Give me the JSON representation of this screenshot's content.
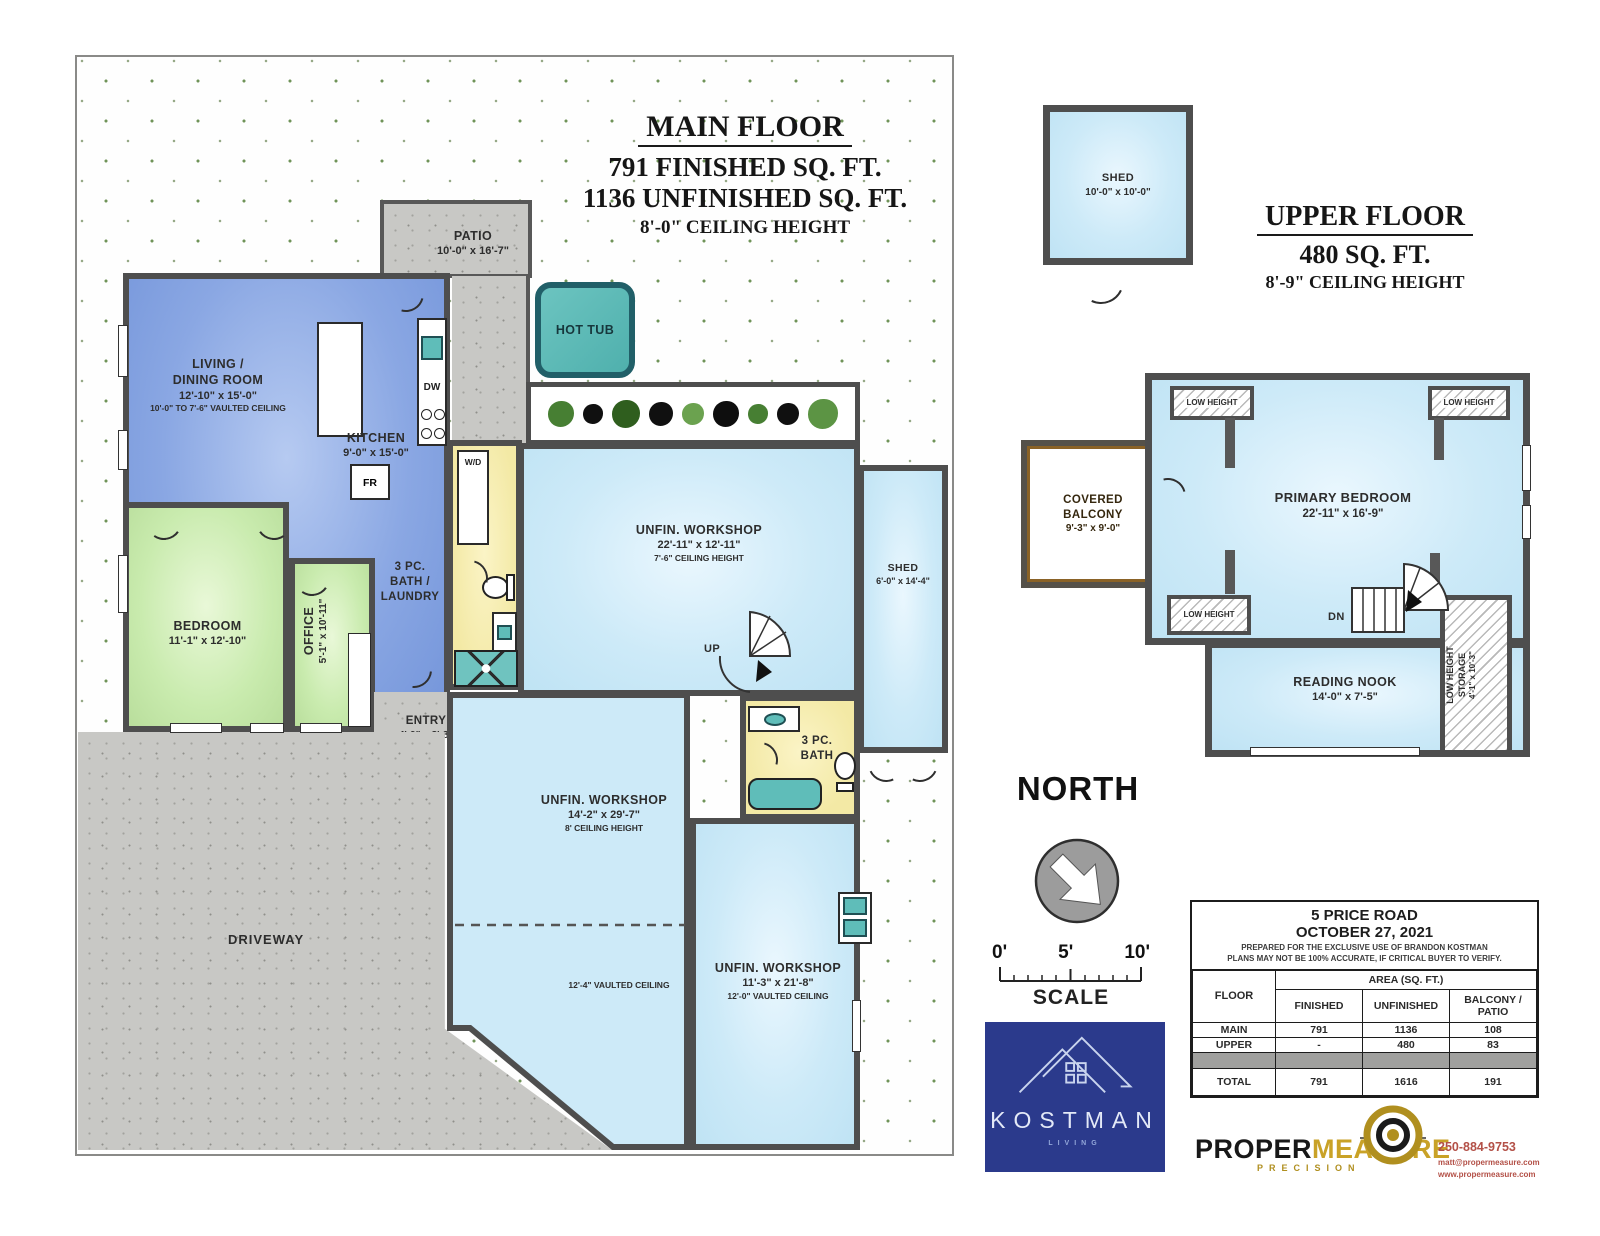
{
  "main_floor": {
    "title": "MAIN FLOOR",
    "finished": "791 FINISHED SQ. FT.",
    "unfinished": "1136 UNFINISHED SQ. FT.",
    "ceiling": "8'-0\" CEILING HEIGHT",
    "living": {
      "l1": "LIVING /",
      "l2": "DINING ROOM",
      "dims": "12'-10\" x 15'-0\"",
      "note": "10'-0\" TO 7'-6\" VAULTED CEILING"
    },
    "kitchen": {
      "name": "KITCHEN",
      "dims": "9'-0\" x 15'-0\""
    },
    "bedroom": {
      "name": "BEDROOM",
      "dims": "11'-1\" x 12'-10\""
    },
    "office": {
      "name": "OFFICE",
      "dims": "5'-1\" x 10'-11\""
    },
    "bath_laundry": {
      "l1": "3 PC.",
      "l2": "BATH /",
      "l3": "LAUNDRY"
    },
    "entry": {
      "name": "ENTRY",
      "dims": "4'-9\" x 8'-8\""
    },
    "patio": {
      "name": "PATIO",
      "dims": "10'-0\" x 16'-7\""
    },
    "hot_tub": "HOT TUB",
    "workshop_top": {
      "name": "UNFIN. WORKSHOP",
      "dims": "22'-11\" x 12'-11\"",
      "note": "7'-6\" CEILING HEIGHT"
    },
    "workshop_mid": {
      "name": "UNFIN. WORKSHOP",
      "dims": "14'-2\" x 29'-7\"",
      "note": "8' CEILING HEIGHT",
      "vault": "12'-4\" VAULTED CEILING"
    },
    "workshop_low": {
      "name": "UNFIN. WORKSHOP",
      "dims": "11'-3\" x 21'-8\"",
      "note": "12'-0\" VAULTED CEILING"
    },
    "bath2": {
      "l1": "3 PC.",
      "l2": "BATH"
    },
    "shed": {
      "name": "SHED",
      "dims": "6'-0\" x 14'-4\""
    },
    "driveway": "DRIVEWAY",
    "up": "UP",
    "appliances": {
      "wd": "W/D",
      "dw": "DW",
      "fr": "FR"
    }
  },
  "upper_floor": {
    "title": "UPPER FLOOR",
    "area": "480 SQ. FT.",
    "ceiling": "8'-9\" CEILING HEIGHT",
    "shed": {
      "name": "SHED",
      "dims": "10'-0\" x 10'-0\""
    },
    "balcony": {
      "l1": "COVERED",
      "l2": "BALCONY",
      "dims": "9'-3\" x 9'-0\""
    },
    "primary": {
      "name": "PRIMARY BEDROOM",
      "dims": "22'-11\" x 16'-9\""
    },
    "low_height": "LOW HEIGHT",
    "dn": "DN",
    "nook": {
      "name": "READING NOOK",
      "dims": "14'-0\" x 7'-5\""
    },
    "storage": {
      "l1": "LOW HEIGHT",
      "l2": "STORAGE",
      "dims": "4'-1\" x 10'-3\""
    }
  },
  "compass": {
    "label": "NORTH"
  },
  "scale": {
    "t0": "0'",
    "t5": "5'",
    "t10": "10'",
    "label": "SCALE"
  },
  "info_table": {
    "address": "5 PRICE ROAD",
    "date": "OCTOBER 27, 2021",
    "disclaimer1": "PREPARED FOR THE EXCLUSIVE USE OF BRANDON KOSTMAN",
    "disclaimer2": "PLANS MAY NOT BE 100% ACCURATE, IF CRITICAL BUYER TO VERIFY.",
    "col_floor": "FLOOR",
    "col_area": "AREA (SQ. FT.)",
    "col_finished": "FINISHED",
    "col_unfinished": "UNFINISHED",
    "col_balcony": "BALCONY /\nPATIO",
    "rows": [
      {
        "floor": "MAIN",
        "finished": "791",
        "unfinished": "1136",
        "balcony": "108"
      },
      {
        "floor": "UPPER",
        "finished": "-",
        "unfinished": "480",
        "balcony": "83"
      },
      {
        "floor": "TOTAL",
        "finished": "791",
        "unfinished": "1616",
        "balcony": "191"
      }
    ]
  },
  "kostman": {
    "name": "KOSTMAN",
    "sub": "LIVING"
  },
  "propermeasure": {
    "p1": "PROPER",
    "p2": "MEASURE",
    "sub": "PRECISION",
    "phone": "250-884-9753",
    "email": "matt@propermeasure.com",
    "web": "www.propermeasure.com"
  },
  "colors": {
    "finished_blue": "#8aa7e3",
    "bedroom_green": "#c9ebae",
    "bath_yellow": "#f3e9a5",
    "unfinished_blue": "#cdeaf8",
    "fixture_teal": "#5fbdb9",
    "wall_gray": "#4e4e4e",
    "balcony_brown": "#b5823b",
    "logo_blue": "#2b3a8c",
    "gold": "#c9a227"
  }
}
